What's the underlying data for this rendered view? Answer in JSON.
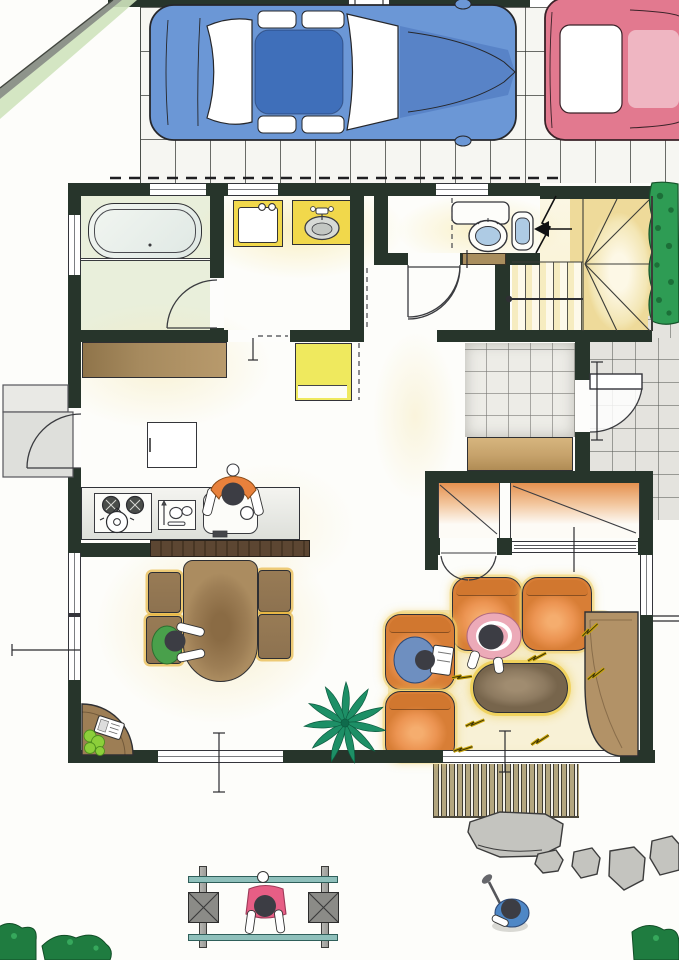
{
  "document": {
    "title": "Hand-drawn house floor plan with garden, driveway and residents",
    "kind": "floor-plan-illustration"
  },
  "palette": {
    "wall": "#27352b",
    "drvtile": "#f6f6f2",
    "porchtile": "#e4e3de",
    "genkantile": "#edece7",
    "boundary": "#8e948b",
    "washgreen": "#cfe3bd",
    "hedge": "#2e9c54",
    "hedgedark": "#1c6f38",
    "bushlight": "#8ccf3a",
    "carblue": "#6b97d6",
    "carbluedk": "#3f6fba",
    "carpink": "#e2798f",
    "carpinklight": "#efb6c2",
    "bathfloor": "#e9efdb",
    "tub": "#eef2ec",
    "fixyellow": "#f1d84b",
    "basin": "#d7dad6",
    "toiletblue": "#aecbe4",
    "stairyellow": "#f3e6b4",
    "sill": "#a98e5e",
    "step": "#c6a26b",
    "closetor": "#e5914f",
    "counter": "#a68a5e",
    "bar": "#5c4632",
    "fridge": "#efe95e",
    "tablebr": "#9d7e55",
    "chairbr": "#8d7250",
    "chairgold": "#dfa52e",
    "sofa": "#ec9452",
    "sofadk": "#d87e36",
    "glow": "#f2d16a",
    "rug": "#f8f1d6",
    "coffee": "#8d7a60",
    "tv": "#b29267",
    "palm": "#1d8f66",
    "deck": "#b3a67f",
    "stone": "#c4c4bf",
    "pole": "#8fc0bb",
    "post": "#9c9c98",
    "base": "#8b8b87",
    "pgreen": "#49a04b",
    "porange": "#e8813c",
    "pblue": "#6e8fc0",
    "ppink": "#ecaab8",
    "childpink": "#e75e85",
    "golfblue": "#4e87c6",
    "spark": "#ecc416",
    "head": "#3c3d44"
  },
  "scene": {
    "exterior": {
      "driveway": {
        "surface": "tile-grid",
        "cars": [
          {
            "name": "sedan-top-view",
            "color_key": "carblue"
          },
          {
            "name": "sedan-top-view",
            "color_key": "carpink"
          }
        ]
      },
      "boundary_fence": "diagonal wall at top-left with green planting strip",
      "hedge": "clipped hedge along right side of stairwell",
      "porch": "grey tiled entrance approach on right side",
      "deck": "wood slat deck below living room",
      "garden": {
        "stepping_stones": 5,
        "laundry_pole_stands": 2,
        "drying_bars": 2,
        "bushes": 3
      }
    },
    "rooms": [
      {
        "name": "bathroom",
        "fixtures": [
          "bathtub",
          "changing-area",
          "door"
        ]
      },
      {
        "name": "washroom",
        "fixtures": [
          "washing-machine",
          "washbasin",
          "sliding-door"
        ]
      },
      {
        "name": "toilet-room",
        "fixtures": [
          "toilet",
          "hand-basin",
          "door"
        ]
      },
      {
        "name": "staircase",
        "fixtures": [
          "winder-stairs",
          "handrail",
          "entry-arrow"
        ]
      },
      {
        "name": "hallway",
        "fixtures": [
          "door-to-hall"
        ]
      },
      {
        "name": "entrance-genkan",
        "fixtures": [
          "tiled-floor",
          "timber-step",
          "front-door"
        ]
      },
      {
        "name": "kitchen",
        "fixtures": [
          "stove",
          "cutting-board",
          "sink",
          "bar-counter",
          "refrigerator",
          "island-table",
          "back-door",
          "side-counter"
        ]
      },
      {
        "name": "dining",
        "fixtures": [
          "dining-table",
          "chair",
          "chair",
          "chair",
          "chair",
          "corner-phone-table",
          "telephone",
          "pot-plant"
        ]
      },
      {
        "name": "living",
        "fixtures": [
          "loveseat",
          "armchair",
          "armchair",
          "coffee-table",
          "rug",
          "tv-corner-board",
          "palm-plant"
        ]
      },
      {
        "name": "closet-small",
        "fixtures": [
          "folding-doors"
        ]
      },
      {
        "name": "closet-large",
        "fixtures": [
          "sliding-doors"
        ]
      }
    ],
    "people": [
      {
        "location": "kitchen",
        "activity": "cooking at sink",
        "shirt_key": "porange"
      },
      {
        "location": "dining table",
        "activity": "sitting on chair",
        "shirt_key": "pgreen"
      },
      {
        "location": "living armchair",
        "activity": "reading newspaper",
        "shirt_key": "pblue"
      },
      {
        "location": "living floor",
        "activity": "sitting against sofa",
        "shirt_key": "ppink"
      },
      {
        "location": "garden drying poles",
        "activity": "hanging laundry",
        "shirt_key": "childpink"
      },
      {
        "location": "garden",
        "activity": "golf practice",
        "shirt_key": "golfblue"
      }
    ]
  }
}
